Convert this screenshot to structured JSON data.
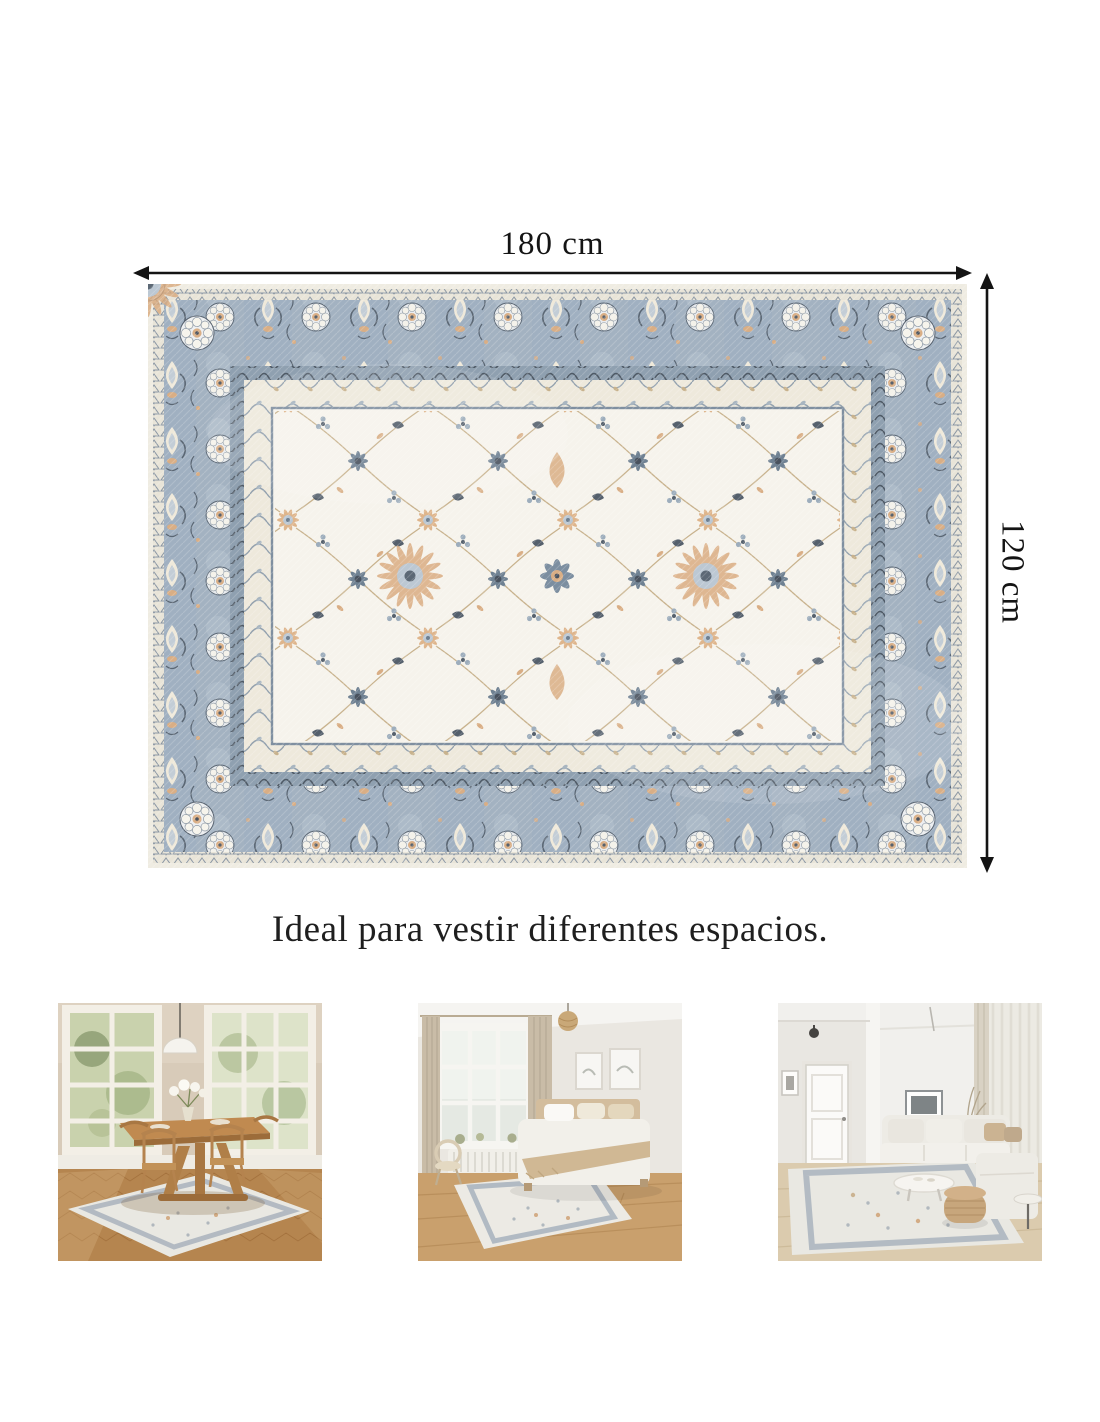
{
  "page": {
    "background": "#ffffff",
    "type": "product-infographic-rug"
  },
  "dimensions": {
    "width_label": "180 cm",
    "height_label": "120 cm",
    "arrow_color": "#141414"
  },
  "headline": "Ideal para vestir diferentes espacios.",
  "rug": {
    "name": "vintage-oriental-area-rug",
    "style": "washed floral oriental pattern",
    "colors": {
      "field_ivory": "#f5f2ea",
      "border_blue_gray": "#a3b2c1",
      "border_dark_slate": "#56616e",
      "motif_slate": "#6f8192",
      "motif_dark": "#49525e",
      "motif_tan": "#d9ae85",
      "guard_cream": "#efe9db",
      "vine_tan": "#c8b28d",
      "outer_edge_cream": "#efece2"
    }
  },
  "gallery": [
    {
      "scene": "dining-room"
    },
    {
      "scene": "bedroom"
    },
    {
      "scene": "living-room"
    }
  ]
}
